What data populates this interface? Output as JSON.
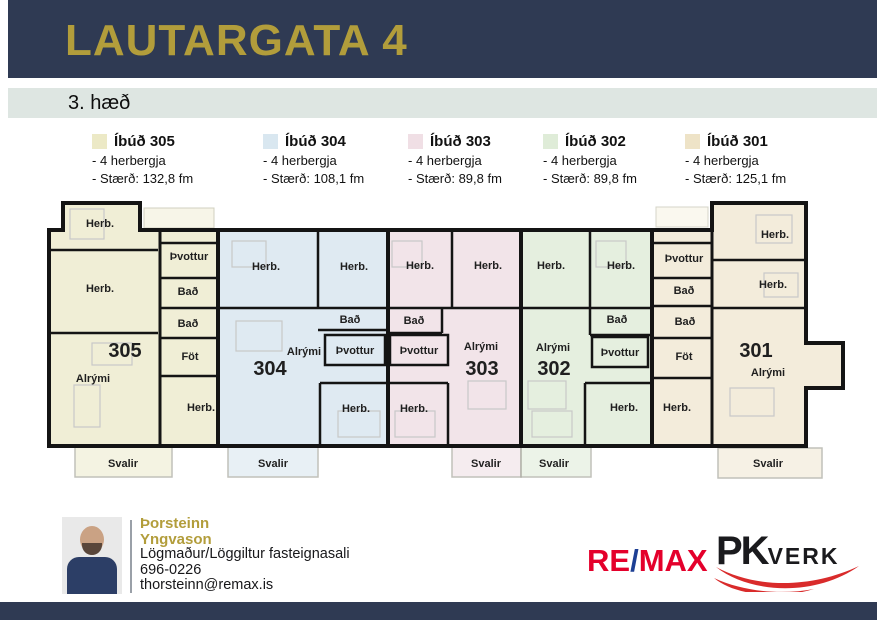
{
  "header": {
    "title": "LAUTARGATA 4"
  },
  "floor_label": "3. hæð",
  "colors": {
    "navy": "#2f3a53",
    "gold": "#b29d3b",
    "apt_305": "#f0eed6",
    "apt_304": "#dfeaf2",
    "apt_303": "#f2e4e9",
    "apt_302": "#e5efdf",
    "apt_301": "#f3ecdb",
    "remax_red": "#e4002b",
    "remax_blue": "#1d3f94",
    "pkverk_red": "#d92b2b"
  },
  "legend": [
    {
      "title": "Íbúð 305",
      "lines": [
        "- 4 herbergja",
        "- Stærð: 132,8 fm"
      ],
      "swatch": "#ece9c6"
    },
    {
      "title": "Íbúð 304",
      "lines": [
        "- 4 herbergja",
        "- Stærð: 108,1 fm"
      ],
      "swatch": "#d9e7f0"
    },
    {
      "title": "Íbúð 303",
      "lines": [
        "- 4 herbergja",
        "- Stærð: 89,8 fm"
      ],
      "swatch": "#f0dfe5"
    },
    {
      "title": "Íbúð 302",
      "lines": [
        "- 4 herbergja",
        "- Stærð: 89,8 fm"
      ],
      "swatch": "#dfecd8"
    },
    {
      "title": "Íbúð 301",
      "lines": [
        "- 4 herbergja",
        "- Stærð: 125,1 fm"
      ],
      "swatch": "#eee3c7"
    }
  ],
  "plan": {
    "apartments": [
      {
        "number": "305",
        "rooms": [
          "Herb.",
          "Þvottur",
          "Herb.",
          "Bað",
          "Bað",
          "Föt",
          "Alrými",
          "Herb.",
          "Svalir"
        ]
      },
      {
        "number": "304",
        "rooms": [
          "Herb.",
          "Herb.",
          "Bað",
          "Alrými",
          "Þvottur",
          "Herb.",
          "Svalir"
        ]
      },
      {
        "number": "303",
        "rooms": [
          "Herb.",
          "Herb.",
          "Bað",
          "Þvottur",
          "Alrými",
          "Herb.",
          "Svalir"
        ]
      },
      {
        "number": "302",
        "rooms": [
          "Herb.",
          "Herb.",
          "Bað",
          "Þvottur",
          "Alrými",
          "Herb.",
          "Svalir"
        ]
      },
      {
        "number": "301",
        "rooms": [
          "Þvottur",
          "Bað",
          "Bað",
          "Föt",
          "Herb.",
          "Herb.",
          "Alrými",
          "Herb.",
          "Svalir"
        ]
      }
    ]
  },
  "footer": {
    "agent": {
      "first_name": "Þorsteinn",
      "last_name": "Yngvason",
      "role": "Lögmaður/Löggiltur fasteignasali",
      "phone": "696-0226",
      "email": "thorsteinn@remax.is"
    },
    "remax": {
      "re": "RE",
      "slash": "/",
      "max": "MAX"
    },
    "pkverk": {
      "pk": "PK",
      "verk": "VERK"
    }
  }
}
